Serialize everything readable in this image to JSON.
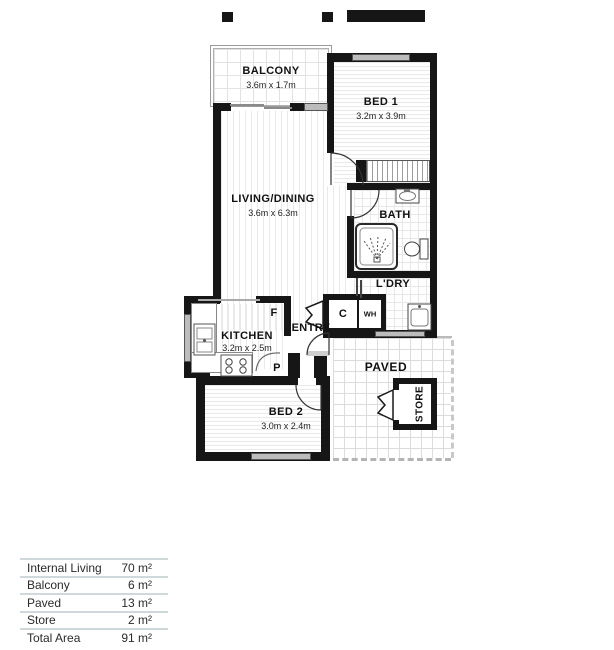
{
  "plan": {
    "rooms": {
      "balcony": {
        "name": "BALCONY",
        "dims": "3.6m x 1.7m"
      },
      "bed1": {
        "name": "BED 1",
        "dims": "3.2m x 3.9m"
      },
      "living": {
        "name": "LIVING/DINING",
        "dims": "3.6m x 6.3m"
      },
      "bath": {
        "name": "BATH"
      },
      "laundry": {
        "name": "L'DRY"
      },
      "entry": {
        "name": "ENTRY"
      },
      "kitchen": {
        "name": "KITCHEN",
        "dims": "3.2m x 2.5m"
      },
      "bed2": {
        "name": "BED 2",
        "dims": "3.0m x 2.4m"
      },
      "paved": {
        "name": "PAVED"
      },
      "store": {
        "name": "STORE"
      }
    },
    "fixtures": {
      "cupboard": "C",
      "water_heater": "WH",
      "fridge": "F",
      "pantry": "P"
    }
  },
  "area_table": {
    "rows": [
      {
        "label": "Internal Living",
        "value": "70 m²"
      },
      {
        "label": "Balcony",
        "value": "6 m²"
      },
      {
        "label": "Paved",
        "value": "13 m²"
      },
      {
        "label": "Store",
        "value": "2 m²"
      },
      {
        "label": "Total Area",
        "value": "91 m²"
      }
    ]
  },
  "colors": {
    "wall": "#161616",
    "window": "#bcbcbc",
    "table_line": "#cfd8da"
  }
}
